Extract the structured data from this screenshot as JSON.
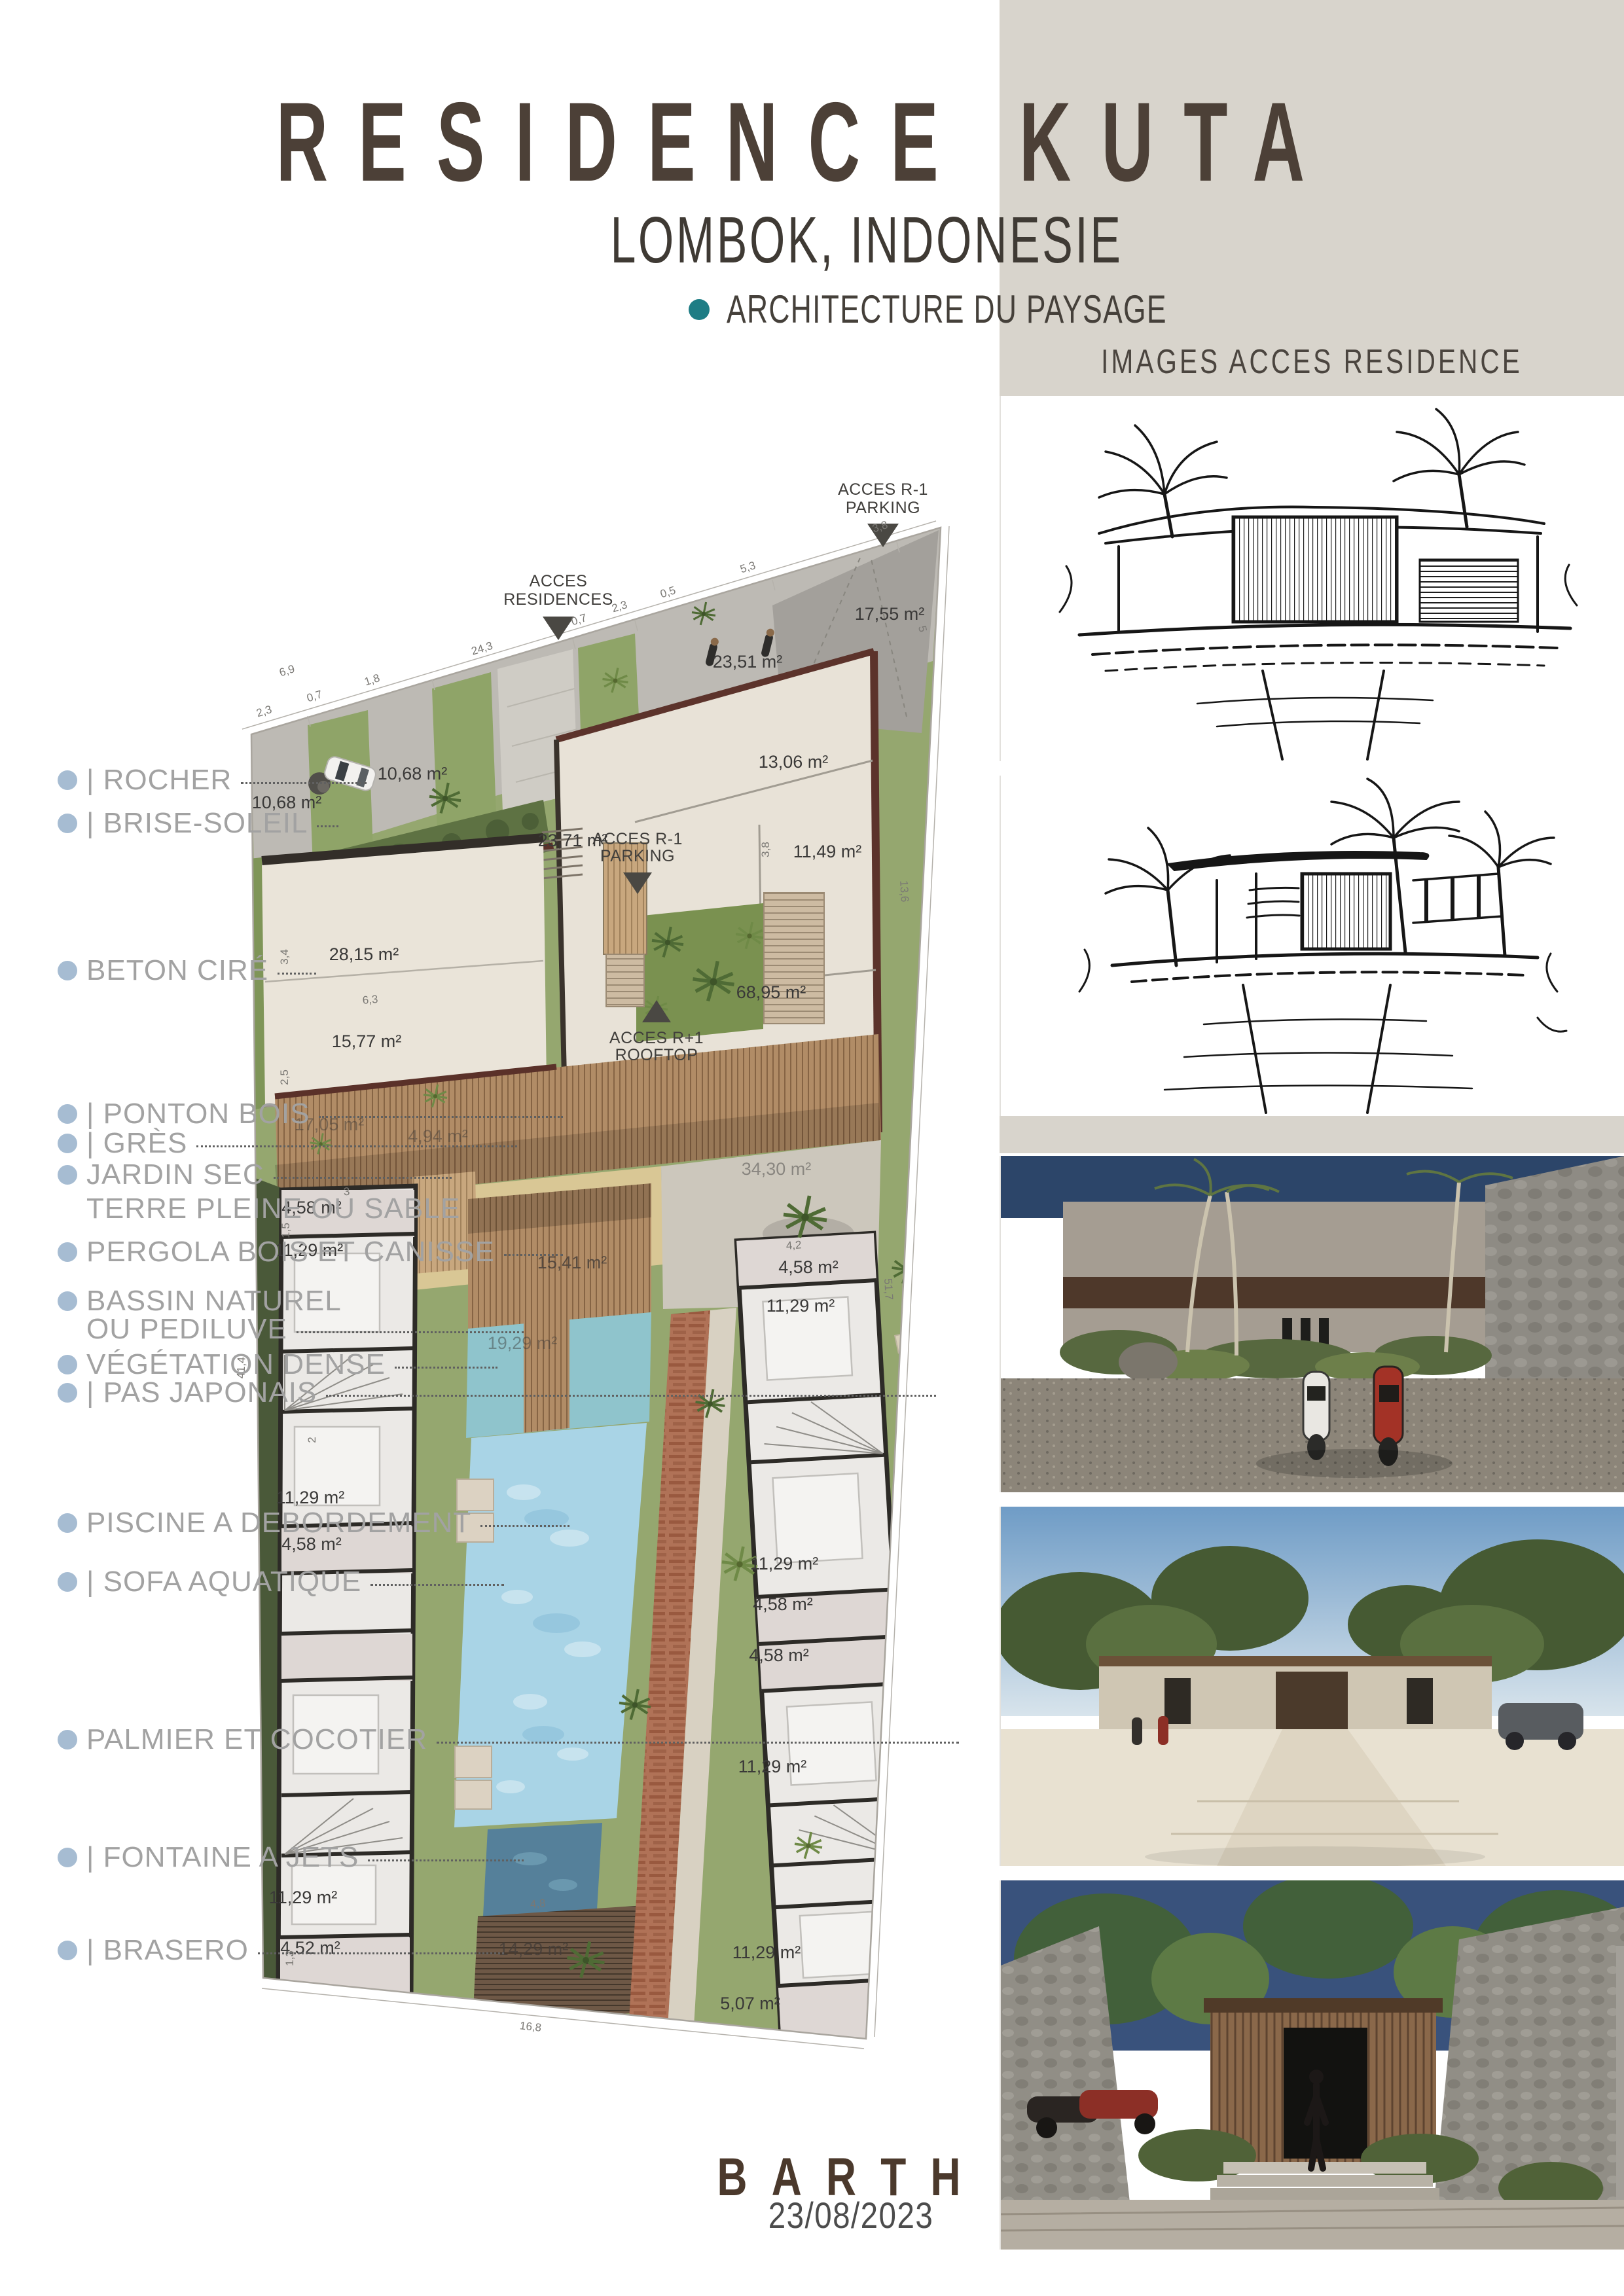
{
  "header": {
    "title": "RESIDENCE KUTA",
    "subtitle": "LOMBOK, INDONESIE",
    "tagline": "ARCHITECTURE DU PAYSAGE"
  },
  "right_column": {
    "heading": "IMAGES ACCES RESIDENCE",
    "images": [
      "ink-sketch-residence-gate-front",
      "ink-sketch-residence-gate-perspective",
      "render-stone-wall-scooters",
      "render-driveway-villas",
      "render-entrance-with-person"
    ]
  },
  "legend": {
    "items": [
      {
        "label": "| ROCHER"
      },
      {
        "label": "| BRISE-SOLEIL"
      },
      {
        "label": "BETON CIRÉ"
      },
      {
        "label": "| PONTON BOIS"
      },
      {
        "label": "| GRÈS"
      },
      {
        "label": "JARDIN SEC",
        "label2": "TERRE PLEINE OU SABLE"
      },
      {
        "label": "PERGOLA BOIS ET CANISSE"
      },
      {
        "label": "BASSIN NATUREL",
        "label2": "OU PEDILUVE"
      },
      {
        "label": "VÉGÉTATION DENSE"
      },
      {
        "label": "| PAS JAPONAIS"
      },
      {
        "label": "PISCINE A DEBORDEMENT"
      },
      {
        "label": "| SOFA AQUATIQUE"
      },
      {
        "label": "PALMIER ET COCOTIER"
      },
      {
        "label": "| FONTAINE A JETS"
      },
      {
        "label": "| BRASERO"
      }
    ]
  },
  "plan": {
    "access": {
      "parking_top": [
        "ACCES R-1",
        "PARKING"
      ],
      "residences": [
        "ACCES",
        "RESIDENCES"
      ],
      "parking_mid": [
        "ACCES R-1",
        "PARKING"
      ],
      "rooftop": [
        "ACCES R+1",
        "ROOFTOP"
      ]
    },
    "areas": [
      "17,55 m²",
      "23,51 m²",
      "13,06 m²",
      "10,68 m²",
      "10,68 m²",
      "23,71 m²",
      "11,49 m²",
      "28,15 m²",
      "68,95 m²",
      "15,77 m²",
      "17,05 m²",
      "4,94 m²",
      "34,30 m²",
      "4,58 m²",
      "11,29 m²",
      "15,41 m²",
      "4,58 m²",
      "11,29 m²",
      "19,29 m²",
      "11,29 m²",
      "4,58 m²",
      "11,29 m²",
      "4,58 m²",
      "4,58 m²",
      "11,29 m²",
      "11,29 m²",
      "4,52 m²",
      "14,29 m²",
      "11,29 m²",
      "5,07 m²"
    ],
    "dims": [
      "2,3",
      "0,7",
      "1,8",
      "24,3",
      "0,7",
      "2,3",
      "0,5",
      "5,3",
      "3,8",
      "5",
      "6,9",
      "41,4",
      "51,7",
      "13,6",
      "16,8",
      "6,3",
      "3,4",
      "2,5",
      "3,8",
      "4,2",
      "3",
      "1,5",
      "2",
      "1,3",
      "4,8"
    ]
  },
  "footer": {
    "logo": "BARTH",
    "date": "23/08/2023"
  },
  "colors": {
    "accent_teal": "#1e7d85",
    "band_beige": "#d8d4cc",
    "bullet_blue": "#a6bcd2",
    "wall_maroon": "#5a3129",
    "pool_blue": "#a9d4e6",
    "title_brown": "#4c4037"
  }
}
